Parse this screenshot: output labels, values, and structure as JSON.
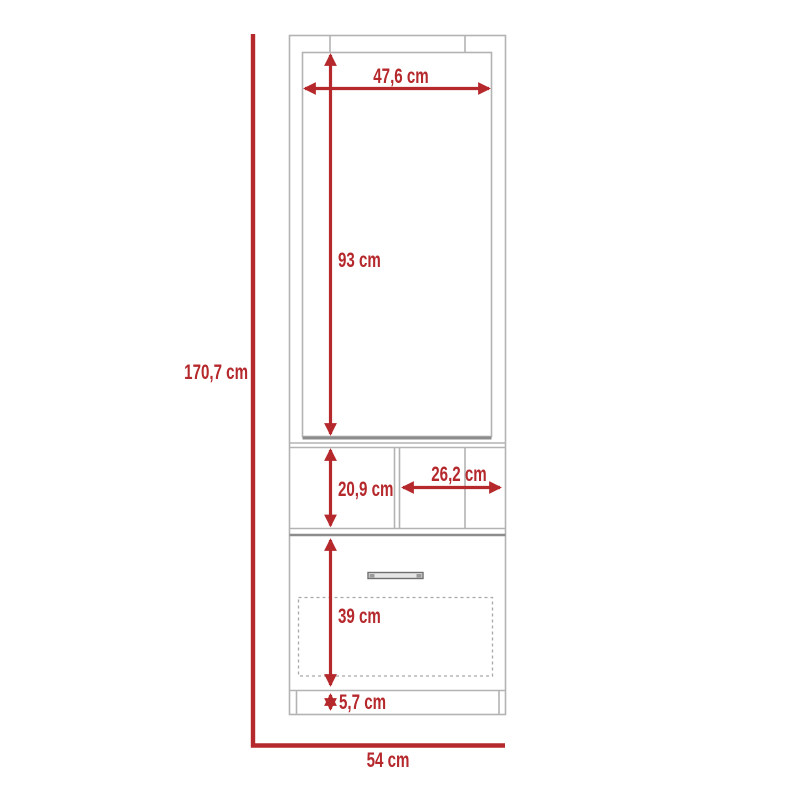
{
  "theme": {
    "accent_color": "#b5282c",
    "outline_color": "#b3b3b3",
    "outline_dark_color": "#8c8c8c",
    "background_color": "#ffffff"
  },
  "diagram": {
    "kind": "furniture-dimension-diagram",
    "dimensions": {
      "overall_height": {
        "label": "170,7 cm",
        "value_cm": 170.7
      },
      "overall_width": {
        "label": "54 cm",
        "value_cm": 54
      },
      "door_width": {
        "label": "47,6 cm",
        "value_cm": 47.6
      },
      "door_height": {
        "label": "93 cm",
        "value_cm": 93
      },
      "shelf_height": {
        "label": "20,9 cm",
        "value_cm": 20.9
      },
      "shelf_width": {
        "label": "26,2 cm",
        "value_cm": 26.2
      },
      "drawer_section_height": {
        "label": "39 cm",
        "value_cm": 39
      },
      "base_height": {
        "label": "5,7 cm",
        "value_cm": 5.7
      }
    }
  }
}
